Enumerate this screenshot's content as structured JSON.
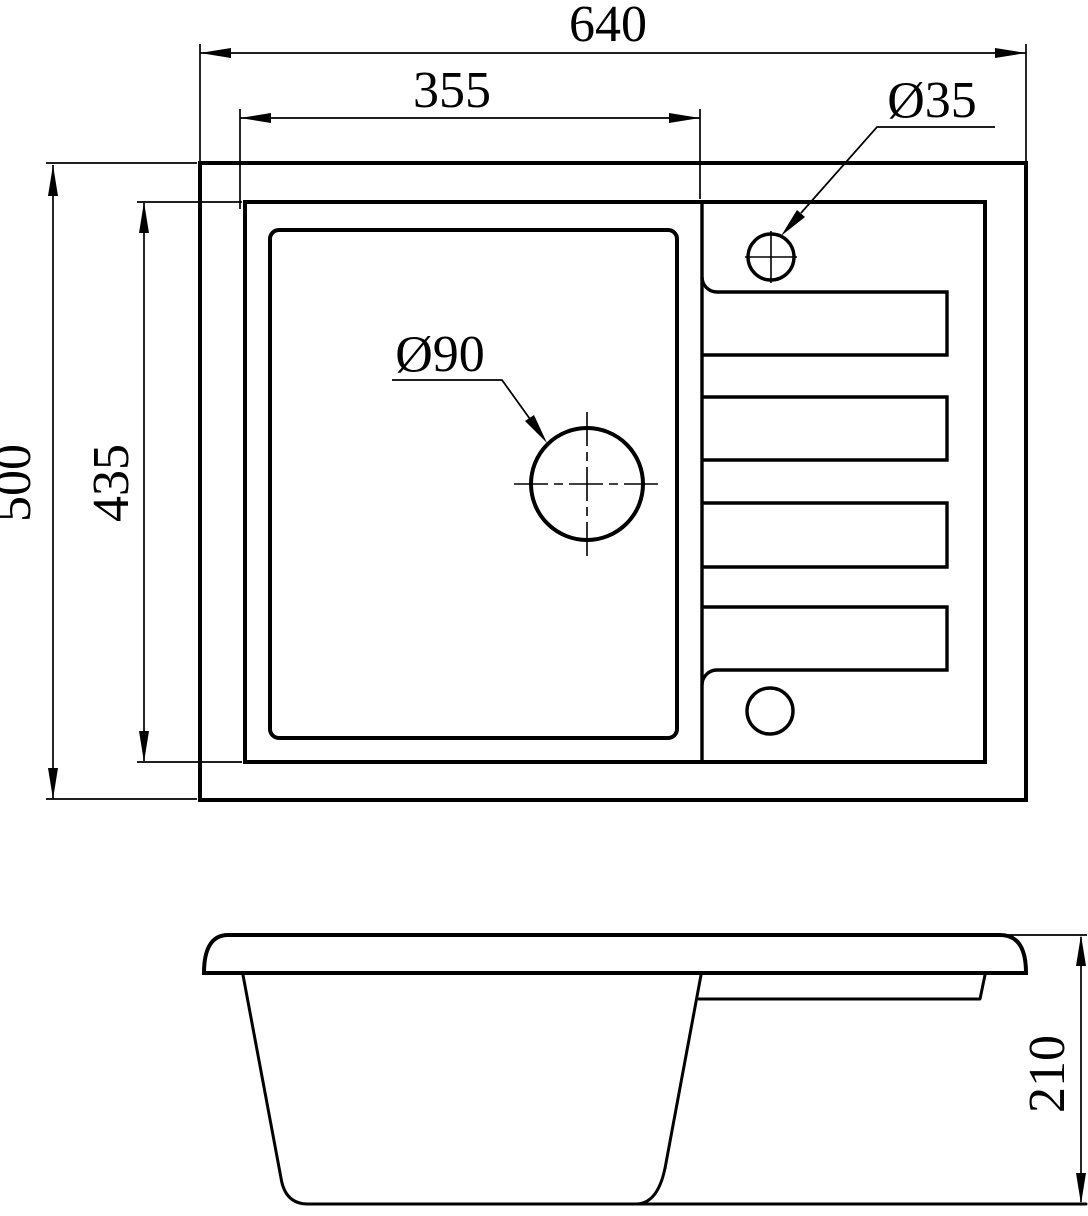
{
  "drawing": {
    "top_view": {
      "overall_width": "640",
      "bowl_opening_width": "355",
      "overall_depth": "500",
      "inner_depth": "435",
      "drain_hole_diameter": "Ø90",
      "faucet_hole_diameter": "Ø35"
    },
    "side_view": {
      "overall_height": "210"
    }
  },
  "colors": {
    "line": "#000000",
    "background": "#ffffff"
  }
}
